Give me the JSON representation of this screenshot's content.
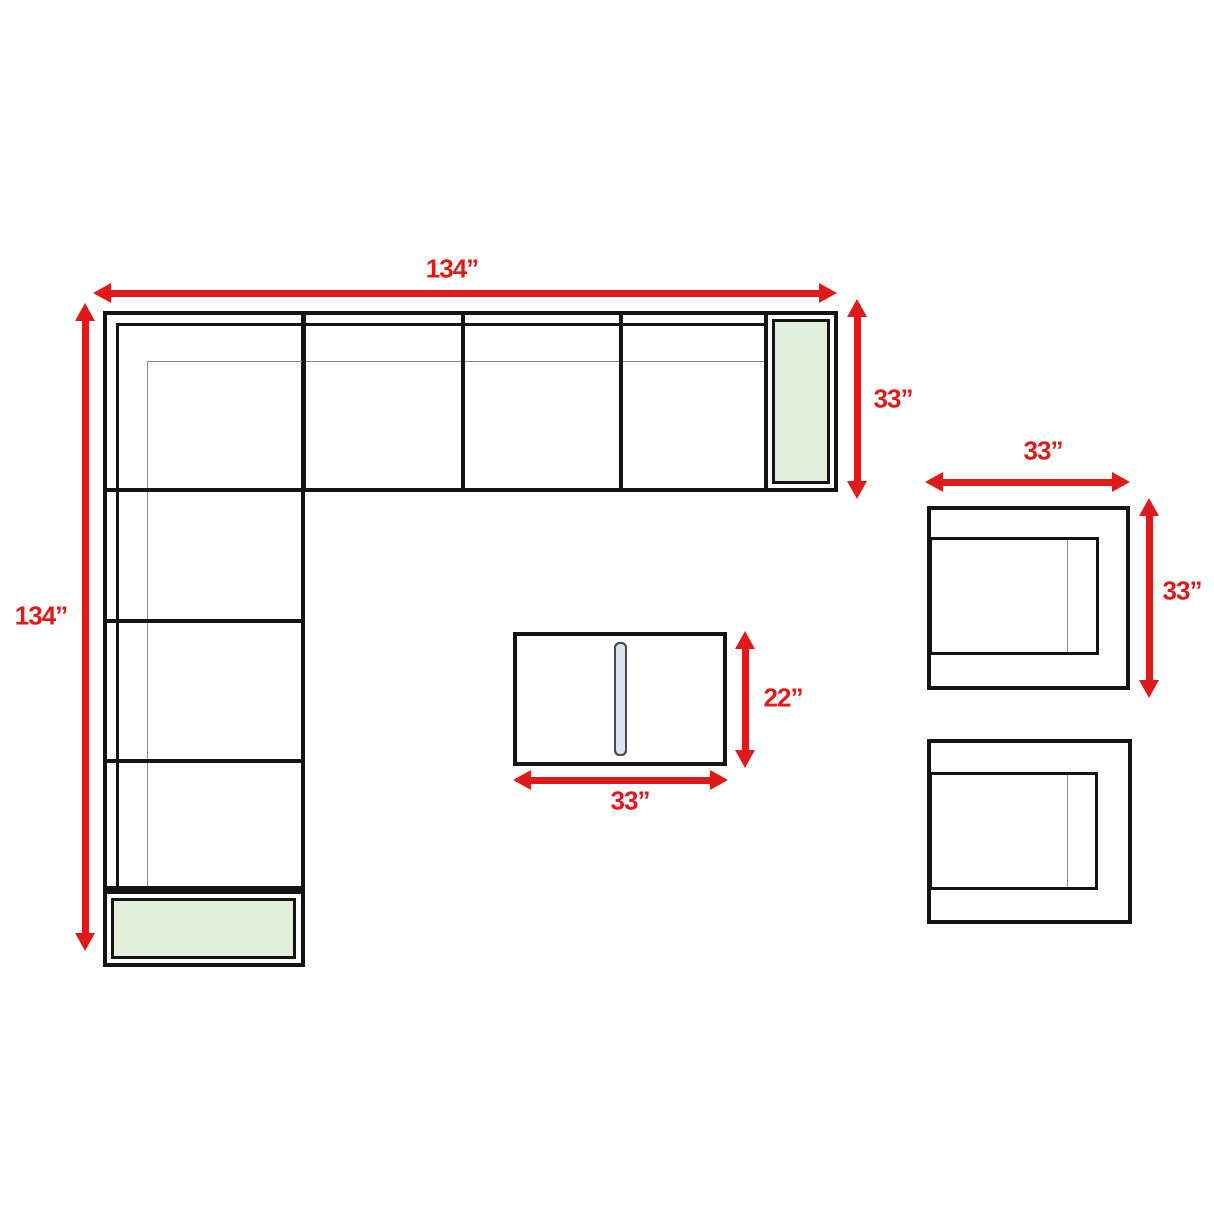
{
  "diagram": {
    "description": "Top-view dimension diagram of an L-shaped sectional sofa set with two armchairs and a slatted coffee table",
    "colors": {
      "dimension_red": "#DF1A1A",
      "armrest_green": "#E2EFDA",
      "slat_blue": "#DAE3F2",
      "slat_border": "#4D4D4D",
      "outline_black": "#141414",
      "thin_gray": "#8A8A8A",
      "background": "#FFFFFF"
    },
    "dimensions": {
      "sofa_total_width": "134”",
      "sofa_total_depth": "134”",
      "sofa_end_depth": "33”",
      "armchair_width": "33”",
      "armchair_depth": "33”",
      "coffee_table_depth": "22”",
      "coffee_table_width": "33”"
    },
    "sofa": {
      "top_row_sections": 4,
      "left_column_sections": 4,
      "shared_corner_section": true,
      "armrest_pads": 2
    },
    "coffee_table": {
      "slat_count": 8
    },
    "armchairs": {
      "count": 2
    }
  }
}
